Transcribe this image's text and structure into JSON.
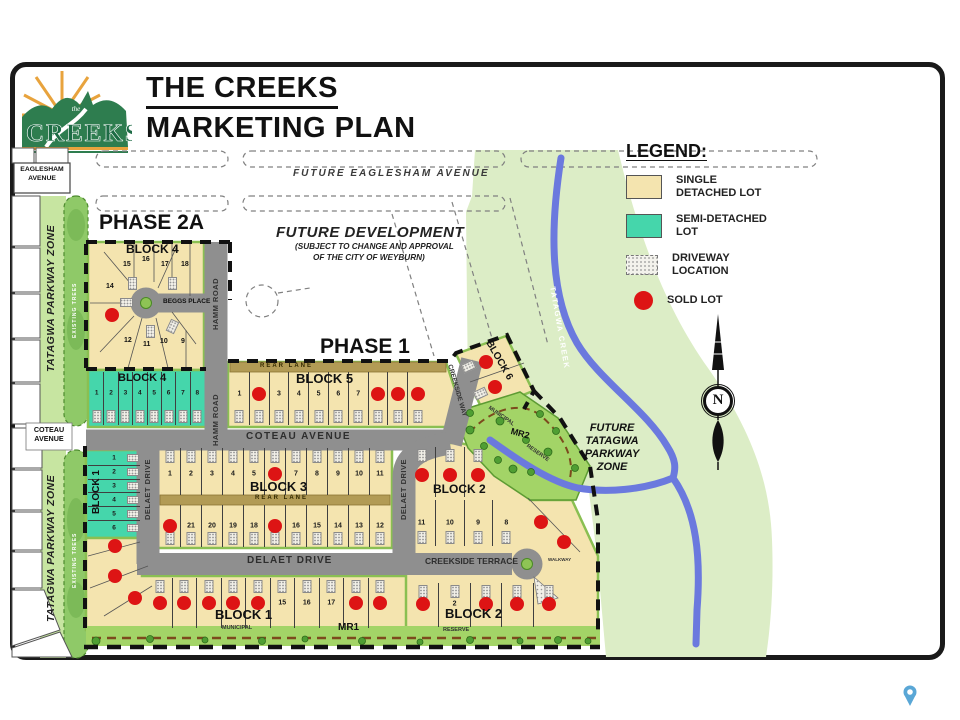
{
  "header": {
    "line1": "THE CREEKS",
    "line2": "MARKETING PLAN",
    "logo_word": "CREEKS",
    "logo_the": "the"
  },
  "legend": {
    "title": "LEGEND:",
    "items": [
      {
        "type": "single",
        "label": "SINGLE\nDETACHED LOT"
      },
      {
        "type": "semi",
        "label": "SEMI-DETACHED\nLOT"
      },
      {
        "type": "driveway",
        "label": "DRIVEWAY\nLOCATION"
      },
      {
        "type": "sold",
        "label": "SOLD LOT"
      }
    ]
  },
  "colors": {
    "lot_single": "#f4e4af",
    "lot_semi": "#45d6ab",
    "sold": "#dd1414",
    "road": "#8f8f8f",
    "parkway": "#dcedc6",
    "strip_green": "#c7e5a1",
    "trees_green": "#8fc968",
    "mr_green": "#a3d467",
    "creek": "#6b79de",
    "rear_lane": "#b29b55",
    "block_edge": "#8abf52",
    "dash_brown": "#7c4a1d",
    "pin": "#5aa7d6"
  },
  "map": {
    "labels": [
      {
        "t": "FUTURE EAGLESHAM AVENUE",
        "x": 293,
        "y": 169,
        "fs": 10,
        "it": 1,
        "w": 600,
        "ls": 2,
        "c": "#3a3a3a"
      },
      {
        "t": "EAGLESHAM",
        "x": 42,
        "y": 167,
        "fs": 6.8,
        "b": 1,
        "ctr": 1
      },
      {
        "t": "AVENUE",
        "x": 42,
        "y": 176,
        "fs": 6.8,
        "b": 1,
        "ctr": 1
      },
      {
        "t": "PHASE 2A",
        "x": 99,
        "y": 212,
        "fs": 21,
        "w": 600,
        "c": "#111"
      },
      {
        "t": "FUTURE DEVELOPMENT",
        "x": 276,
        "y": 225,
        "fs": 15,
        "it": 1,
        "w": 600,
        "ls": 0.5,
        "c": "#222"
      },
      {
        "t": "(SUBJECT TO CHANGE AND APPROVAL",
        "x": 295,
        "y": 243,
        "fs": 8.2,
        "it": 1,
        "b": 1,
        "c": "#222"
      },
      {
        "t": "OF THE CITY OF WEYBURN)",
        "x": 313,
        "y": 254,
        "fs": 8.2,
        "it": 1,
        "b": 1,
        "c": "#222"
      },
      {
        "t": "PHASE 1",
        "x": 320,
        "y": 336,
        "fs": 21,
        "w": 600,
        "c": "#111"
      },
      {
        "t": "BLOCK 4",
        "x": 126,
        "y": 243,
        "fs": 12,
        "b": 1
      },
      {
        "t": "BEGGS PLACE",
        "x": 163,
        "y": 299,
        "fs": 6.5,
        "b": 1
      },
      {
        "t": "HAMM ROAD",
        "x": 212,
        "y": 330,
        "fs": 7.5,
        "b": 1,
        "rot": -90,
        "c": "#333",
        "ls": 0.5
      },
      {
        "t": "HAMM ROAD",
        "x": 212,
        "y": 446,
        "fs": 7.5,
        "b": 1,
        "rot": -90,
        "c": "#333",
        "ls": 0.5
      },
      {
        "t": "BLOCK 4",
        "x": 118,
        "y": 373,
        "fs": 11,
        "b": 1
      },
      {
        "t": "REAR LANE",
        "x": 260,
        "y": 363,
        "fs": 6,
        "b": 1,
        "c": "#332a00",
        "ls": 2
      },
      {
        "t": "BLOCK 5",
        "x": 296,
        "y": 372,
        "fs": 13,
        "b": 1
      },
      {
        "t": "CREEKSIDE WAY",
        "x": 452,
        "y": 364,
        "fs": 6.5,
        "b": 1,
        "rot": 74,
        "c": "#333"
      },
      {
        "t": "COTEAU AVENUE",
        "x": 246,
        "y": 432,
        "fs": 10,
        "b": 1,
        "c": "#2e2e2e",
        "ls": 1.5
      },
      {
        "t": "COTEAU",
        "x": 49,
        "y": 426,
        "fs": 7.2,
        "b": 1,
        "ctr": 1
      },
      {
        "t": "AVENUE",
        "x": 49,
        "y": 435,
        "fs": 7.2,
        "b": 1,
        "ctr": 1
      },
      {
        "t": "BLOCK 3",
        "x": 250,
        "y": 480,
        "fs": 13,
        "b": 1
      },
      {
        "t": "REAR LANE",
        "x": 255,
        "y": 495,
        "fs": 6,
        "b": 1,
        "c": "#332a00",
        "ls": 2
      },
      {
        "t": "DELAET DRIVE",
        "x": 144,
        "y": 520,
        "fs": 7.5,
        "b": 1,
        "rot": -90,
        "c": "#333",
        "ls": 0.5
      },
      {
        "t": "DELAET DRIVE",
        "x": 400,
        "y": 520,
        "fs": 7.5,
        "b": 1,
        "rot": -90,
        "c": "#333",
        "ls": 0.5
      },
      {
        "t": "DELAET DRIVE",
        "x": 247,
        "y": 556,
        "fs": 10,
        "b": 1,
        "c": "#2e2e2e",
        "ls": 1
      },
      {
        "t": "BLOCK 1",
        "x": 92,
        "y": 514,
        "fs": 10,
        "b": 1,
        "rot": -90
      },
      {
        "t": "BLOCK 1",
        "x": 215,
        "y": 608,
        "fs": 13,
        "b": 1
      },
      {
        "t": "CREEKSIDE TERRACE",
        "x": 425,
        "y": 557,
        "fs": 8.5,
        "b": 1,
        "c": "#2e2e2e"
      },
      {
        "t": "BLOCK 2",
        "x": 433,
        "y": 483,
        "fs": 12,
        "b": 1
      },
      {
        "t": "BLOCK 2",
        "x": 445,
        "y": 607,
        "fs": 13,
        "b": 1
      },
      {
        "t": "BLOCK 6",
        "x": 492,
        "y": 339,
        "fs": 10,
        "b": 1,
        "rot": 60
      },
      {
        "t": "MR2",
        "x": 512,
        "y": 427,
        "fs": 9,
        "b": 1,
        "rot": 15
      },
      {
        "t": "MUNICIPAL",
        "x": 490,
        "y": 406,
        "fs": 5.5,
        "b": 1,
        "rot": 35,
        "c": "#333"
      },
      {
        "t": "RESERVE",
        "x": 528,
        "y": 444,
        "fs": 5.5,
        "b": 1,
        "rot": 35,
        "c": "#333"
      },
      {
        "t": "MUNICIPAL",
        "x": 222,
        "y": 626,
        "fs": 5.5,
        "b": 1,
        "c": "#333"
      },
      {
        "t": "MR1",
        "x": 338,
        "y": 623,
        "fs": 10,
        "b": 1
      },
      {
        "t": "RESERVE",
        "x": 443,
        "y": 628,
        "fs": 5.5,
        "b": 1,
        "c": "#333"
      },
      {
        "t": "WALKWAY",
        "x": 548,
        "y": 558,
        "fs": 4.5,
        "b": 1,
        "c": "#333"
      },
      {
        "t": "TATAGWA PARKWAY ZONE",
        "x": 46,
        "y": 372,
        "fs": 10.5,
        "b": 1,
        "it": 1,
        "rot": -90,
        "c": "#222",
        "ls": 0.5
      },
      {
        "t": "TATAGWA PARKWAY ZONE",
        "x": 46,
        "y": 622,
        "fs": 10.5,
        "b": 1,
        "it": 1,
        "rot": -90,
        "c": "#222",
        "ls": 0.5
      },
      {
        "t": "EXISTING TREES",
        "x": 73,
        "y": 338,
        "fs": 5,
        "b": 1,
        "rot": -90,
        "c": "#fff",
        "ls": 1
      },
      {
        "t": "EXISTING TREES",
        "x": 73,
        "y": 588,
        "fs": 5,
        "b": 1,
        "rot": -90,
        "c": "#fff",
        "ls": 1
      },
      {
        "t": "TATAGWA CREEK",
        "x": 556,
        "y": 286,
        "fs": 7.5,
        "b": 1,
        "rot": 80,
        "c": "#fff",
        "ls": 1.5
      },
      {
        "t": "FUTURE",
        "x": 612,
        "y": 423,
        "fs": 11,
        "b": 1,
        "it": 1,
        "ctr": 1
      },
      {
        "t": "TATAGWA",
        "x": 612,
        "y": 436,
        "fs": 11,
        "b": 1,
        "it": 1,
        "ctr": 1
      },
      {
        "t": "PARKWAY",
        "x": 612,
        "y": 449,
        "fs": 11,
        "b": 1,
        "it": 1,
        "ctr": 1
      },
      {
        "t": "ZONE",
        "x": 612,
        "y": 462,
        "fs": 11,
        "b": 1,
        "it": 1,
        "ctr": 1
      },
      {
        "t": "N",
        "x": 718,
        "y": 393,
        "fs": 15,
        "b": 1,
        "ctr": 1,
        "sf": 1
      },
      {
        "t": "14",
        "x": 106,
        "y": 283,
        "fs": 7,
        "b": 1
      },
      {
        "t": "15",
        "x": 123,
        "y": 261,
        "fs": 7,
        "b": 1
      },
      {
        "t": "16",
        "x": 142,
        "y": 256,
        "fs": 7,
        "b": 1
      },
      {
        "t": "17",
        "x": 161,
        "y": 261,
        "fs": 7,
        "b": 1
      },
      {
        "t": "18",
        "x": 181,
        "y": 261,
        "fs": 7,
        "b": 1
      },
      {
        "t": "12",
        "x": 124,
        "y": 337,
        "fs": 7,
        "b": 1
      },
      {
        "t": "11",
        "x": 143,
        "y": 341,
        "fs": 7,
        "b": 1
      },
      {
        "t": "10",
        "x": 160,
        "y": 338,
        "fs": 7,
        "b": 1
      },
      {
        "t": "9",
        "x": 181,
        "y": 338,
        "fs": 7,
        "b": 1
      }
    ],
    "lot_rows": [
      {
        "name": "block4-semi",
        "x": 90,
        "y": 372,
        "w": 114,
        "h": 53,
        "drive": "bottom",
        "ny": 40,
        "fs": 6.5,
        "lots": [
          {
            "n": "1"
          },
          {
            "n": "2"
          },
          {
            "n": "3"
          },
          {
            "n": "4"
          },
          {
            "n": "5"
          },
          {
            "n": "6"
          },
          {
            "n": "7"
          },
          {
            "n": "8"
          }
        ]
      },
      {
        "name": "block5",
        "x": 230,
        "y": 372,
        "w": 197,
        "h": 53,
        "drive": "bottom",
        "ny": 42,
        "lots": [
          {
            "n": "1"
          },
          {
            "n": "2",
            "s": 1
          },
          {
            "n": "3"
          },
          {
            "n": "4"
          },
          {
            "n": "5"
          },
          {
            "n": "6"
          },
          {
            "n": "7"
          },
          {
            "n": "8",
            "s": 1
          },
          {
            "n": "9",
            "s": 1
          },
          {
            "n": "10",
            "s": 1
          }
        ]
      },
      {
        "name": "block3-north",
        "x": 160,
        "y": 448,
        "w": 230,
        "h": 47,
        "drive": "top",
        "ny": 55,
        "lots": [
          {
            "n": "1"
          },
          {
            "n": "2"
          },
          {
            "n": "3"
          },
          {
            "n": "4"
          },
          {
            "n": "5"
          },
          {
            "n": "6",
            "s": 1
          },
          {
            "n": "7"
          },
          {
            "n": "8"
          },
          {
            "n": "9"
          },
          {
            "n": "10"
          },
          {
            "n": "11"
          }
        ]
      },
      {
        "name": "block3-south",
        "x": 160,
        "y": 505,
        "w": 230,
        "h": 42,
        "drive": "bottom",
        "ny": 50,
        "lots": [
          {
            "n": "22",
            "s": 1
          },
          {
            "n": "21"
          },
          {
            "n": "20"
          },
          {
            "n": "19"
          },
          {
            "n": "18"
          },
          {
            "n": "17",
            "s": 1
          },
          {
            "n": "16"
          },
          {
            "n": "15"
          },
          {
            "n": "14"
          },
          {
            "n": "13"
          },
          {
            "n": "12"
          }
        ]
      },
      {
        "name": "block1-semi",
        "x": 88,
        "y": 452,
        "w": 52,
        "h": 82,
        "vert": 1,
        "drive": "right",
        "ny": 50,
        "fs": 6.5,
        "lots": [
          {
            "n": "1"
          },
          {
            "n": "2"
          },
          {
            "n": "3"
          },
          {
            "n": "4"
          },
          {
            "n": "5"
          },
          {
            "n": "6"
          }
        ]
      },
      {
        "name": "block1-south",
        "x": 148,
        "y": 578,
        "w": 244,
        "h": 50,
        "drive": "top",
        "ny": 50,
        "lots": [
          {
            "n": "10",
            "s": 1
          },
          {
            "n": "11",
            "s": 1
          },
          {
            "n": "12",
            "s": 1
          },
          {
            "n": "13",
            "s": 1
          },
          {
            "n": "14",
            "s": 1
          },
          {
            "n": "15"
          },
          {
            "n": "16"
          },
          {
            "n": "17"
          },
          {
            "n": "18",
            "s": 1
          },
          {
            "n": "19",
            "s": 1
          }
        ]
      },
      {
        "name": "block2-north",
        "x": 408,
        "y": 447,
        "w": 84,
        "h": 50,
        "drive": "top",
        "ny": 55,
        "lots": [
          {
            "n": "12",
            "s": 1
          },
          {
            "n": "13",
            "s": 1
          },
          {
            "n": "14",
            "s": 1
          }
        ]
      },
      {
        "name": "block2-mid",
        "x": 408,
        "y": 500,
        "w": 112,
        "h": 46,
        "drive": "bottom",
        "ny": 50,
        "lots": [
          {
            "n": "11"
          },
          {
            "n": "10"
          },
          {
            "n": "9"
          },
          {
            "n": "8"
          }
        ]
      },
      {
        "name": "block2-south",
        "x": 408,
        "y": 583,
        "w": 156,
        "h": 44,
        "drive": "top",
        "ny": 48,
        "lots": [
          {
            "n": "1",
            "s": 1
          },
          {
            "n": "2"
          },
          {
            "n": "3",
            "s": 1
          },
          {
            "n": "4",
            "s": 1
          },
          {
            "n": "5",
            "s": 1
          }
        ]
      }
    ],
    "sold_dots": [
      [
        112,
        315
      ],
      [
        115,
        546
      ],
      [
        115,
        576
      ],
      [
        135,
        598
      ],
      [
        486,
        362
      ],
      [
        495,
        387
      ],
      [
        541,
        522
      ],
      [
        564,
        542
      ]
    ],
    "hatches": [
      [
        128,
        277,
        0
      ],
      [
        168,
        277,
        0
      ],
      [
        122,
        296,
        90
      ],
      [
        146,
        325,
        0
      ],
      [
        168,
        320,
        25
      ],
      [
        464,
        360,
        65
      ],
      [
        476,
        387,
        65
      ]
    ]
  }
}
